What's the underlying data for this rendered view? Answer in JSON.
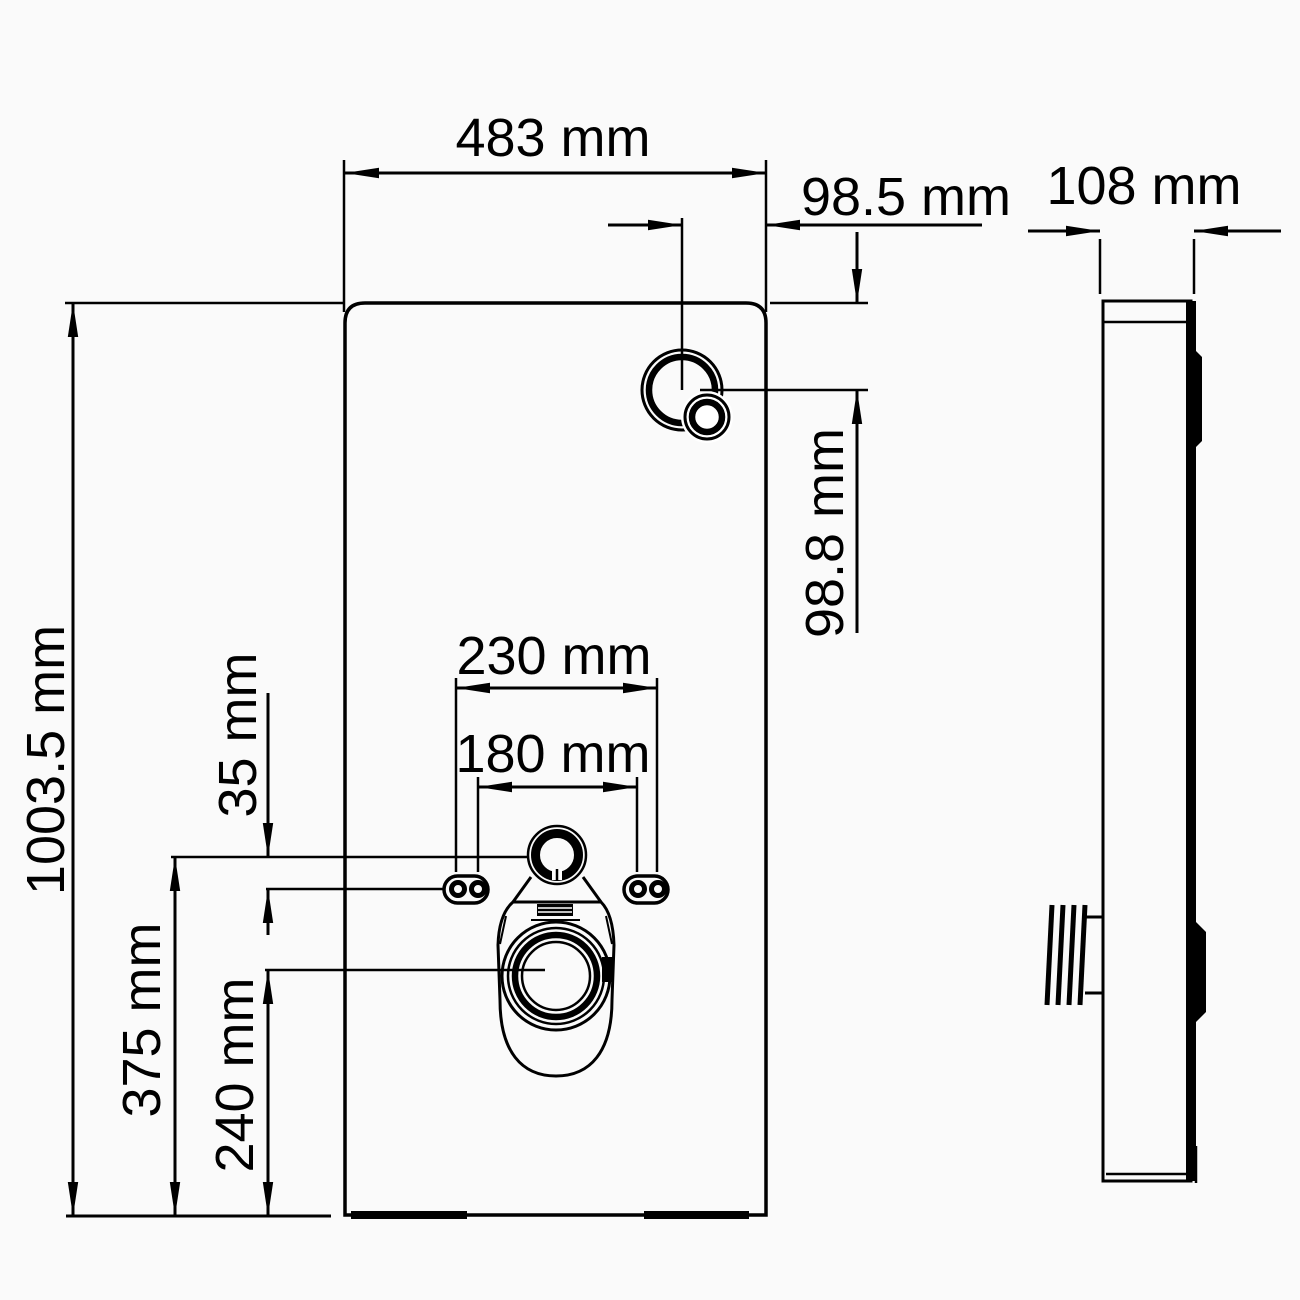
{
  "page": {
    "background": "#fafafa",
    "line_color": "#000000",
    "description": "Technical dimension drawing of a sanitary cistern module, front view and side view"
  },
  "drawing": {
    "dims": {
      "front_width": "483 mm",
      "front_height": "1003.5 mm",
      "button_offset_horizontal": "98.5 mm",
      "button_offset_vertical": "98.8 mm",
      "outer_bolt_spacing": "230 mm",
      "inner_bolt_spacing": "180 mm",
      "supply_to_bolt_line": "35 mm",
      "supply_height_from_floor": "375 mm",
      "outlet_height_from_floor": "240 mm",
      "side_depth": "108 mm"
    }
  }
}
